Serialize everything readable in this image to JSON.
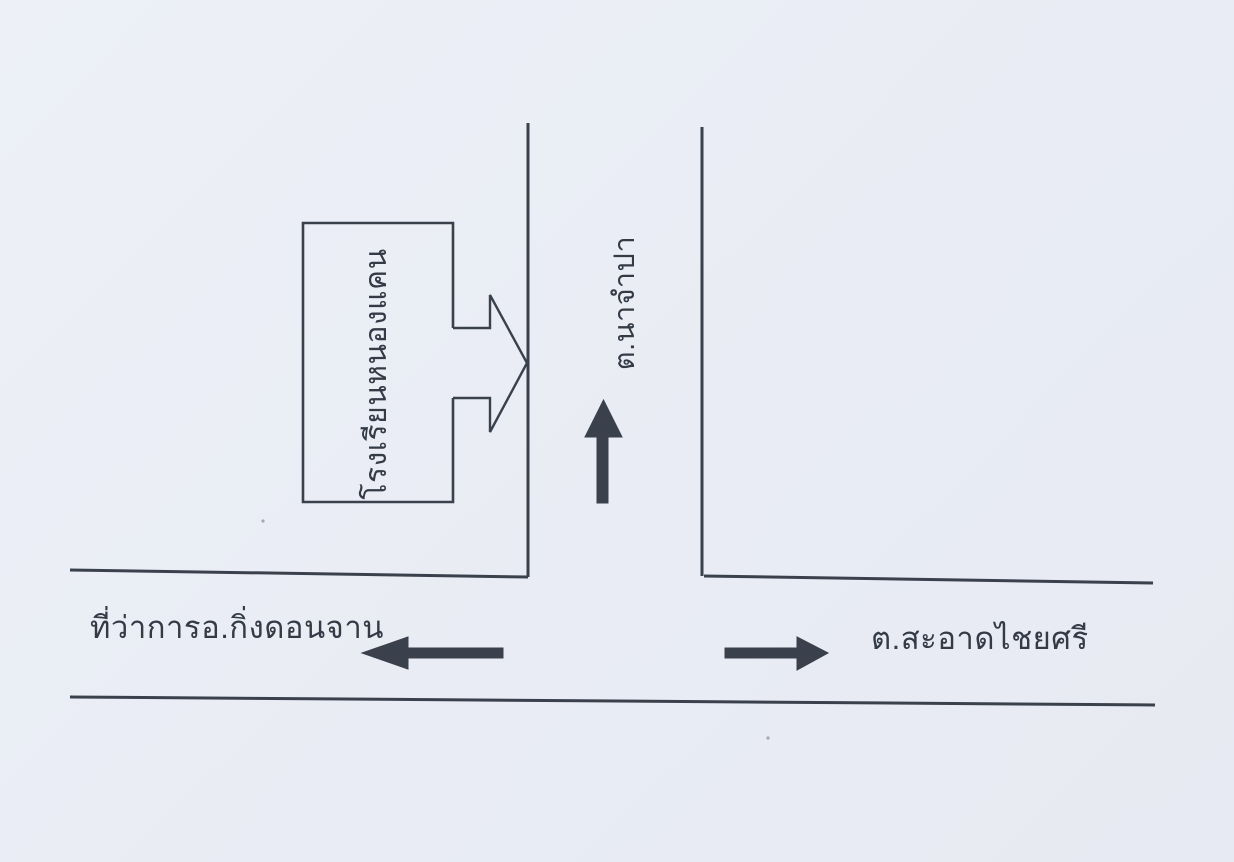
{
  "document": {
    "type": "scanned-direction-map",
    "colors": {
      "background": "#e9ecf4",
      "ink": "#3a404c",
      "text": "#343a46"
    }
  },
  "map": {
    "school_box_label": "โรงเรียนหนองแคน",
    "vertical_road_label": "ต.นาจำปา",
    "left_destination_label": "ที่ว่าการอ.กิ่งดอนจาน",
    "right_destination_label": "ต.สะอาดไชยศรี",
    "arrow_directions": {
      "school_entrance_arrow": "right",
      "vertical_road_arrow": "up",
      "left_road_arrow": "left",
      "right_road_arrow": "right"
    }
  }
}
